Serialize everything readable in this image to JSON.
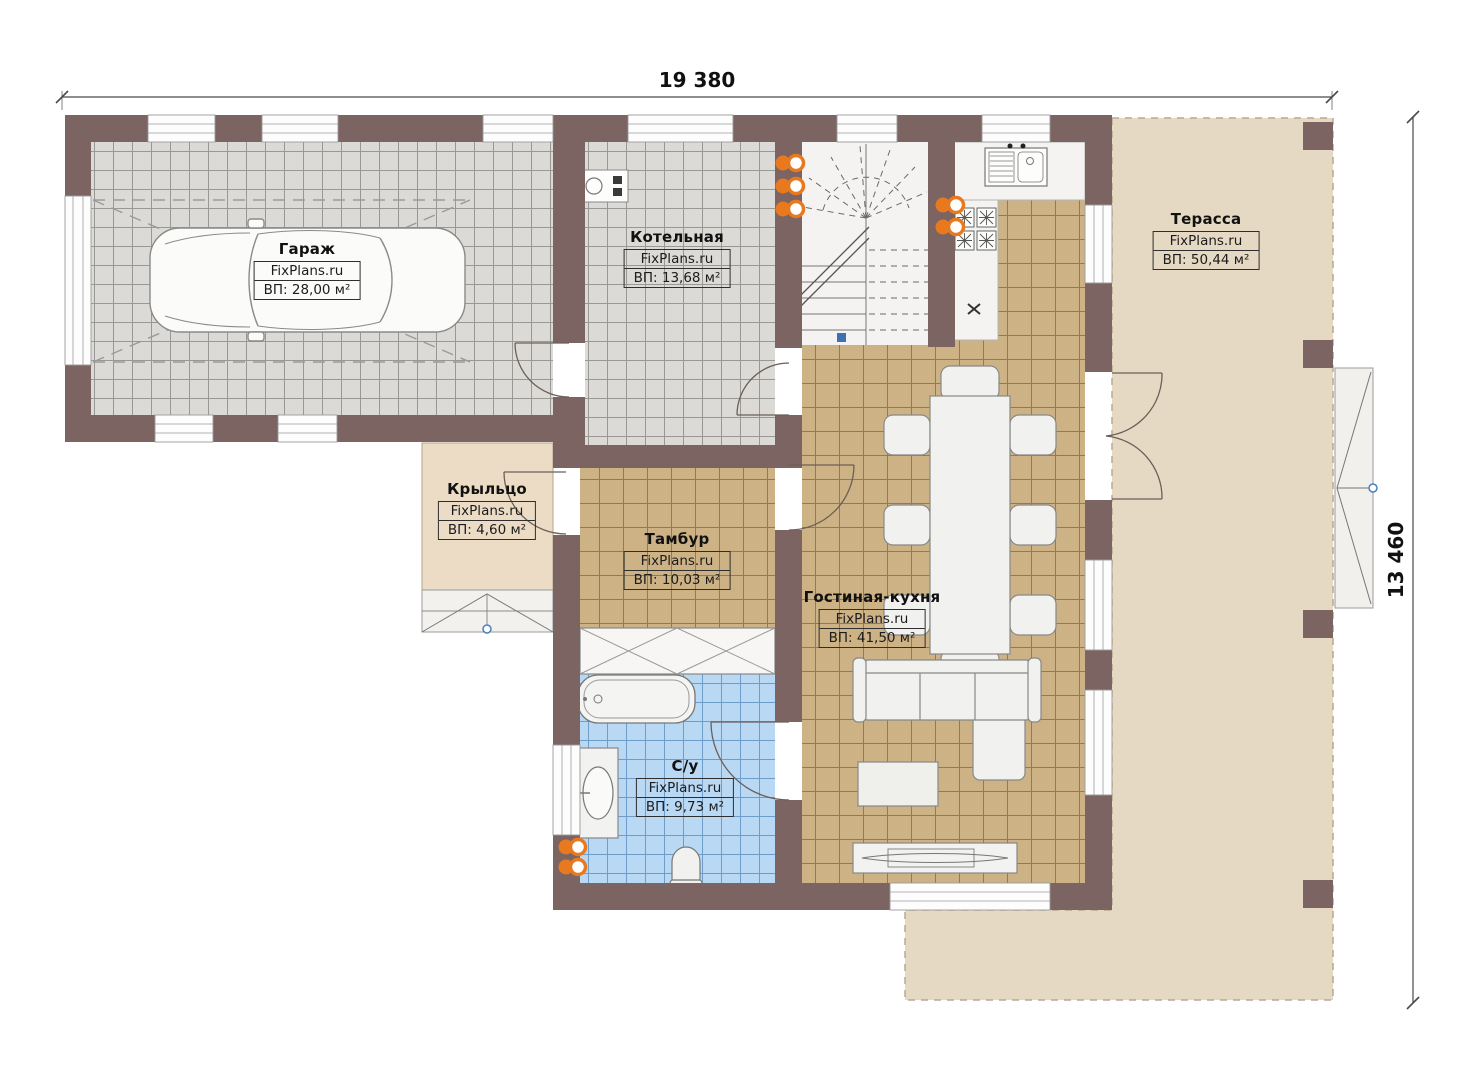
{
  "dimensions": {
    "width": "19 380",
    "height": "13 460"
  },
  "rooms": [
    {
      "name": "Гараж",
      "brand": "FixPlans.ru",
      "area": "ВП: 28,00 м²"
    },
    {
      "name": "Котельная",
      "brand": "FixPlans.ru",
      "area": "ВП: 13,68 м²"
    },
    {
      "name": "Терасса",
      "brand": "FixPlans.ru",
      "area": "ВП: 50,44 м²"
    },
    {
      "name": "Крыльцо",
      "brand": "FixPlans.ru",
      "area": "ВП: 4,60 м²"
    },
    {
      "name": "Тамбур",
      "brand": "FixPlans.ru",
      "area": "ВП: 10,03 м²"
    },
    {
      "name": "Гостиная-кухня",
      "brand": "FixPlans.ru",
      "area": "ВП: 41,50 м²"
    },
    {
      "name": "С/у",
      "brand": "FixPlans.ru",
      "area": "ВП: 9,73 м²"
    }
  ],
  "colors": {
    "wall": "#7b6461",
    "tile_gray": "#dbdad7",
    "tile_tan": "#cdb285",
    "tile_blue": "#b9d8f4",
    "terrace": "#e6d9c3",
    "porch": "#ecdcc6",
    "radiator_orange": "#e8791f",
    "marker_blue": "#4a7fc1"
  }
}
